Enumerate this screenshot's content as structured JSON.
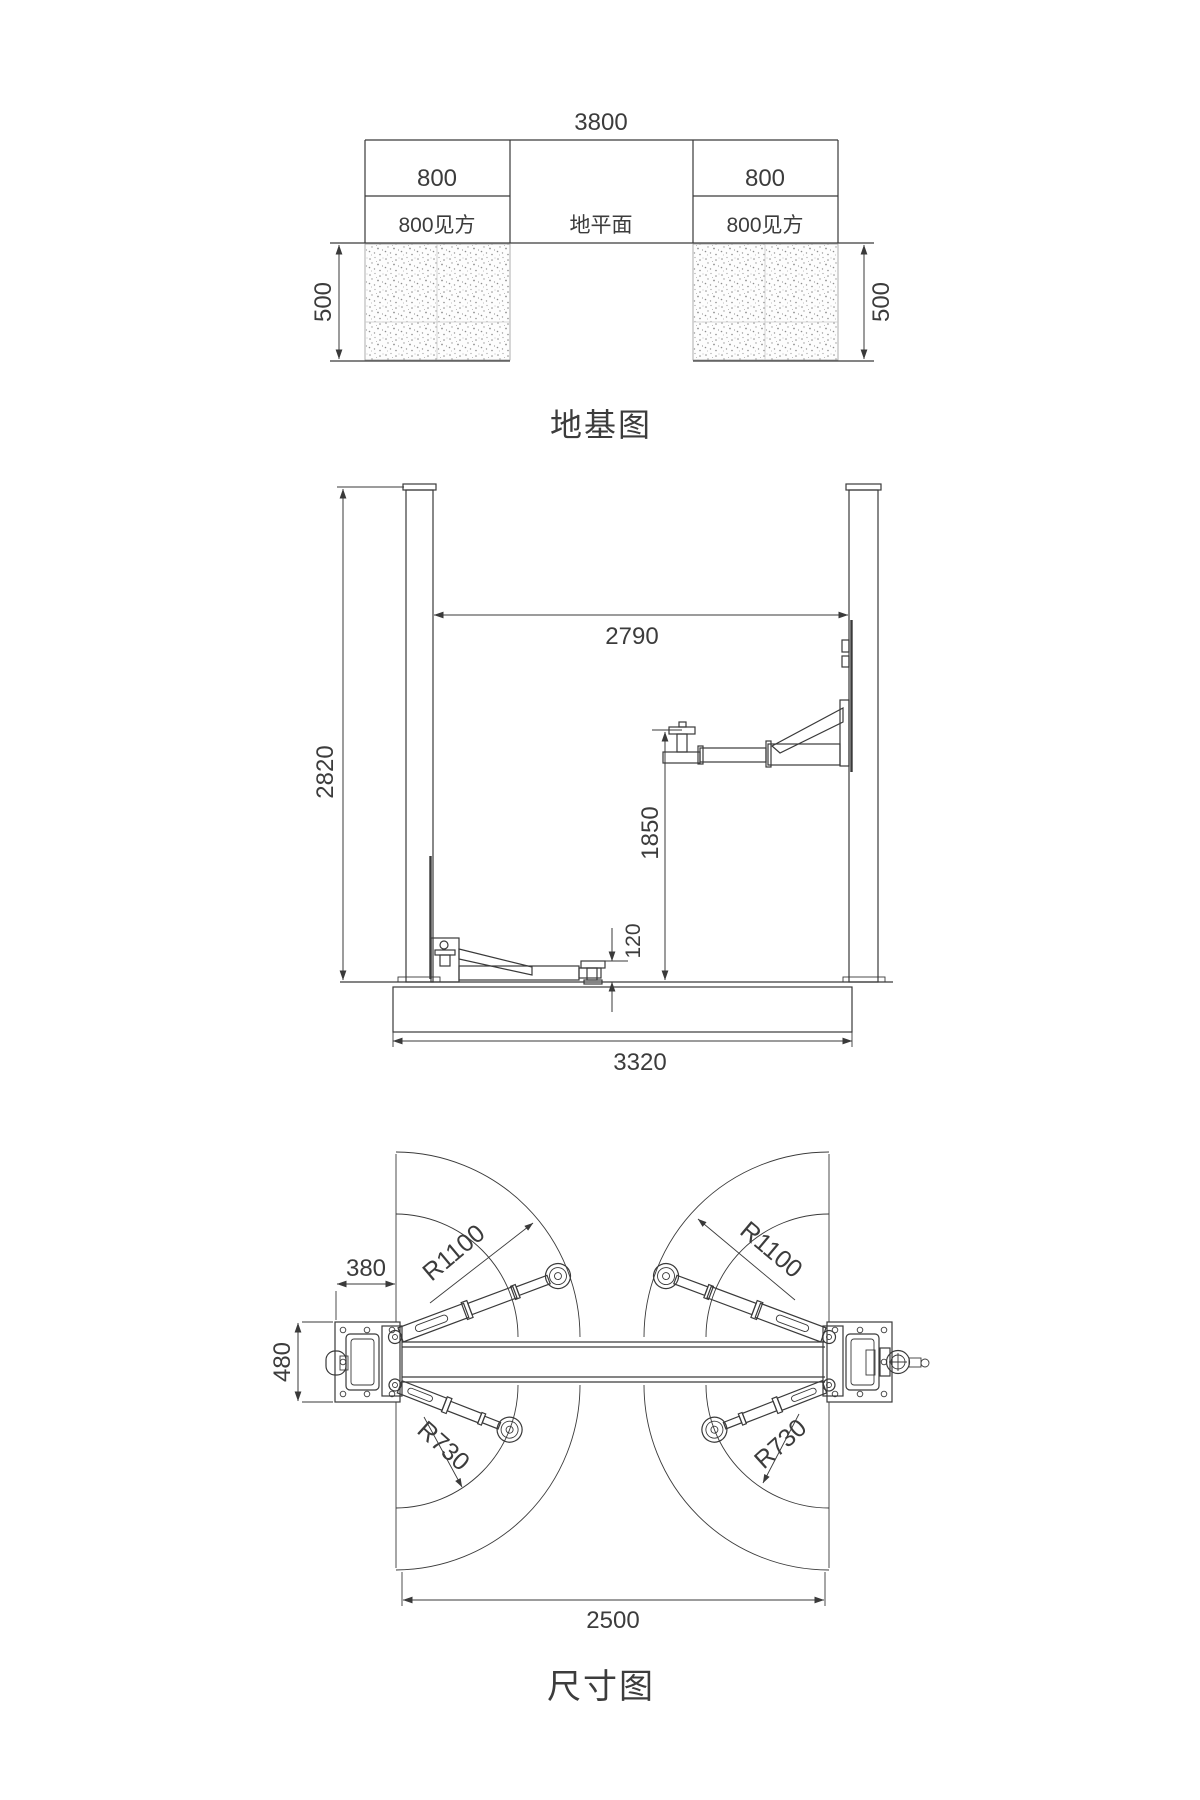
{
  "colors": {
    "line": "#3a3a3a",
    "text": "#3c3c3c",
    "stipple": "#8f8f8f",
    "background": "#ffffff"
  },
  "foundation_view": {
    "title": "地基图",
    "dims": {
      "overall_width": "3800",
      "pad_width_left": "800",
      "pad_width_right": "800",
      "pad_square_left": "800见方",
      "pad_square_right": "800见方",
      "ground_label": "地平面",
      "depth_left": "500",
      "depth_right": "500"
    }
  },
  "front_view": {
    "dims": {
      "clear_span": "2790",
      "column_height": "2820",
      "max_lift_height": "1850",
      "min_pad_height": "120",
      "base_width": "3320"
    }
  },
  "plan_view": {
    "title": "尺寸图",
    "dims": {
      "post_offset": "380",
      "post_depth": "480",
      "long_arm_radius_left": "R1100",
      "long_arm_radius_right": "R1100",
      "short_arm_radius_left": "R730",
      "short_arm_radius_right": "R730",
      "inner_span": "2500"
    }
  }
}
